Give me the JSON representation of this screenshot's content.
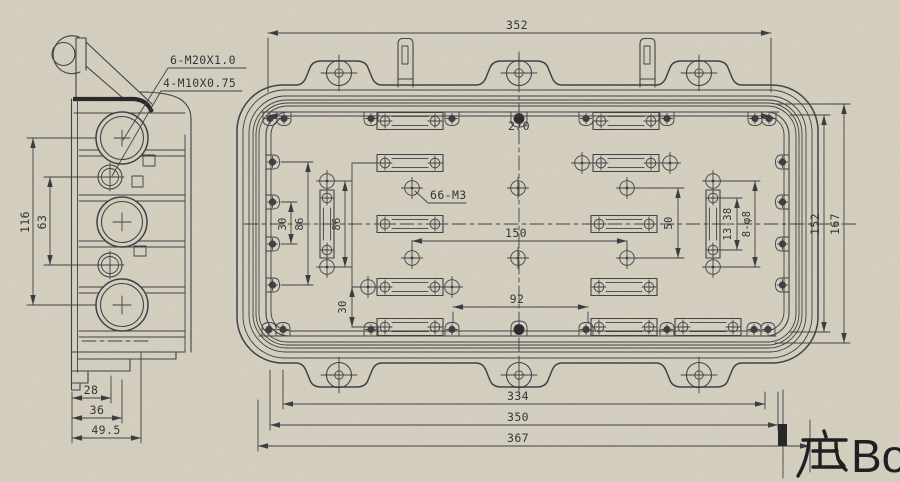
{
  "colors": {
    "paper": "#d7d2c1",
    "ink": "#34343c",
    "dark_ink": "#1b1b22"
  },
  "title": {
    "cjk": "底",
    "latin": "Bott"
  },
  "side_view": {
    "callout_m20": "6-M20X1.0",
    "callout_m10": "4-M10X0.75",
    "dim_116": "116",
    "dim_63": "63",
    "dim_28": "28",
    "dim_36": "36",
    "dim_49_5": "49.5"
  },
  "bottom_view": {
    "dim_352": "352",
    "dim_270": "270",
    "dim_150": "150",
    "dim_92": "92",
    "dim_334": "334",
    "dim_350": "350",
    "dim_367": "367",
    "dim_152": "152",
    "dim_167": "167",
    "dim_30_left": "30",
    "dim_86_left": "86",
    "dim_86_slot": "86",
    "dim_30_lower": "30",
    "dim_50": "50",
    "dim_13_38": "13-38",
    "dim_8_d8": "8-φ8",
    "callout_66_m3": "66-M3"
  }
}
